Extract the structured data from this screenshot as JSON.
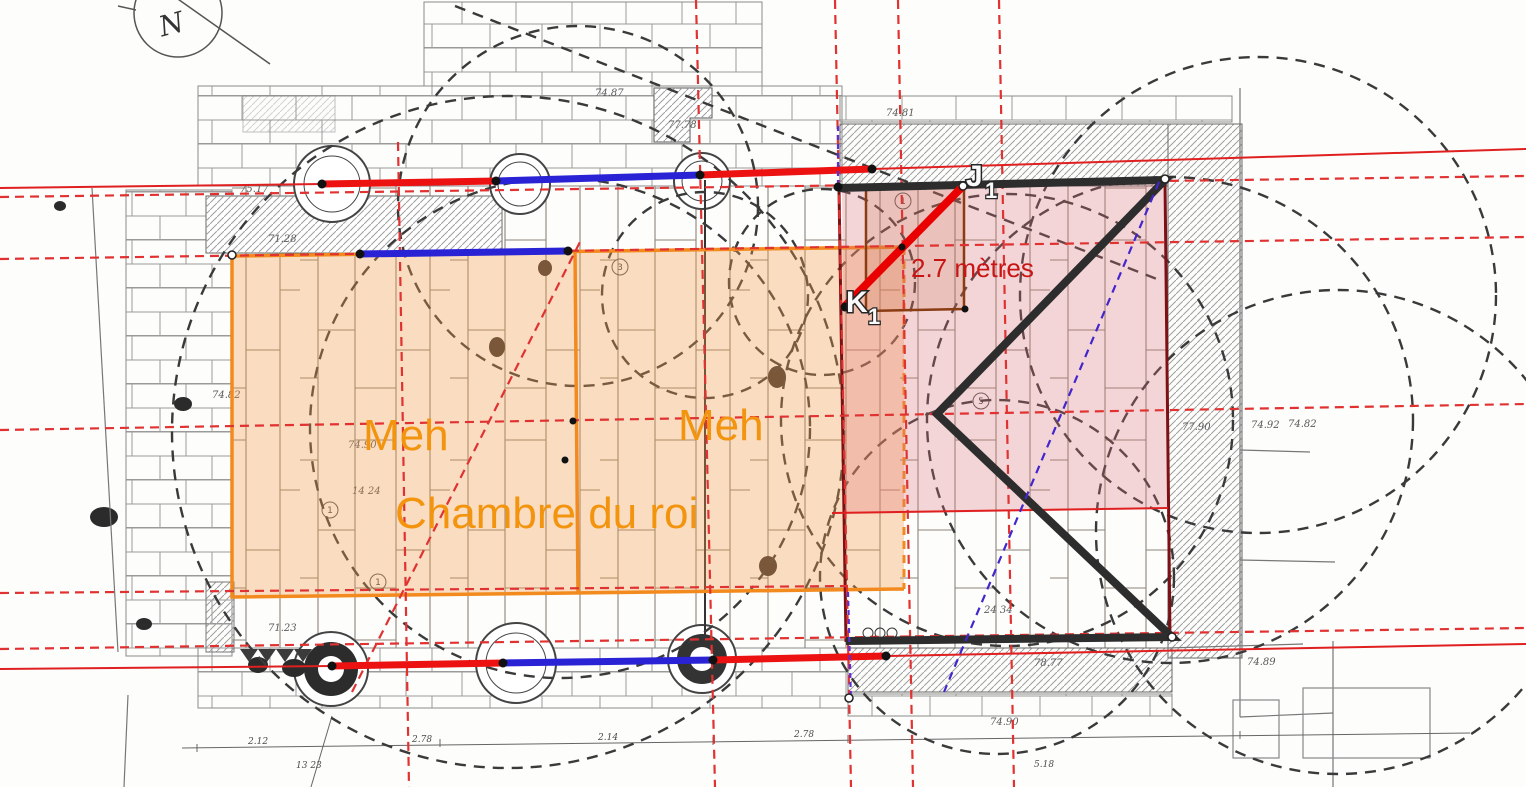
{
  "overlay_labels": {
    "meh_left": "Meh",
    "meh_right": "Meh",
    "chamber": "Chambre du roi",
    "measurement": "2.7 mètres",
    "point_j": "J",
    "point_j_sub": "1",
    "point_k": "K",
    "point_k_sub": "1"
  },
  "compass": {
    "label": "N"
  },
  "survey_numbers": [
    {
      "t": "74.87",
      "x": 595,
      "y": 96
    },
    {
      "t": "77.78",
      "x": 668,
      "y": 128
    },
    {
      "t": "75.17",
      "x": 240,
      "y": 192
    },
    {
      "t": "71.28",
      "x": 268,
      "y": 242
    },
    {
      "t": "74.82",
      "x": 212,
      "y": 398
    },
    {
      "t": "74.90",
      "x": 348,
      "y": 448
    },
    {
      "t": "14  24",
      "x": 352,
      "y": 494
    },
    {
      "t": "71.23",
      "x": 268,
      "y": 631
    },
    {
      "t": "74.81",
      "x": 886,
      "y": 116
    },
    {
      "t": "77.90",
      "x": 1182,
      "y": 430
    },
    {
      "t": "74.92",
      "x": 1251,
      "y": 428
    },
    {
      "t": "74.82",
      "x": 1288,
      "y": 427
    },
    {
      "t": "24 34",
      "x": 984,
      "y": 613
    },
    {
      "t": "78.77",
      "x": 1034,
      "y": 666
    },
    {
      "t": "74.89",
      "x": 1247,
      "y": 665
    },
    {
      "t": "74.90",
      "x": 990,
      "y": 725
    }
  ],
  "dimension_numbers": [
    {
      "t": "2.12",
      "x": 248,
      "y": 744
    },
    {
      "t": "2.78",
      "x": 412,
      "y": 742
    },
    {
      "t": "2.14",
      "x": 598,
      "y": 740
    },
    {
      "t": "2.78",
      "x": 794,
      "y": 737
    },
    {
      "t": "13 23",
      "x": 296,
      "y": 768
    },
    {
      "t": "5.18",
      "x": 1034,
      "y": 767
    }
  ],
  "circled_numbers": [
    {
      "t": "1",
      "x": 330,
      "y": 513
    },
    {
      "t": "1",
      "x": 378,
      "y": 585
    },
    {
      "t": "3",
      "x": 620,
      "y": 270
    },
    {
      "t": "1",
      "x": 903,
      "y": 204
    },
    {
      "t": "5",
      "x": 981,
      "y": 404
    }
  ],
  "colors": {
    "orange_overlay": "#F29C4D",
    "orange_border": "#F28A1E",
    "orange_text": "#F3940E",
    "pink_overlay": "#E06E78",
    "red_accent": "#EC1212",
    "dark_red": "#7D1014",
    "blue_accent": "#2A23D6",
    "purple_dashed": "#5B2FD6",
    "black_figure": "#2D2D2D",
    "red_text": "#C81616"
  }
}
